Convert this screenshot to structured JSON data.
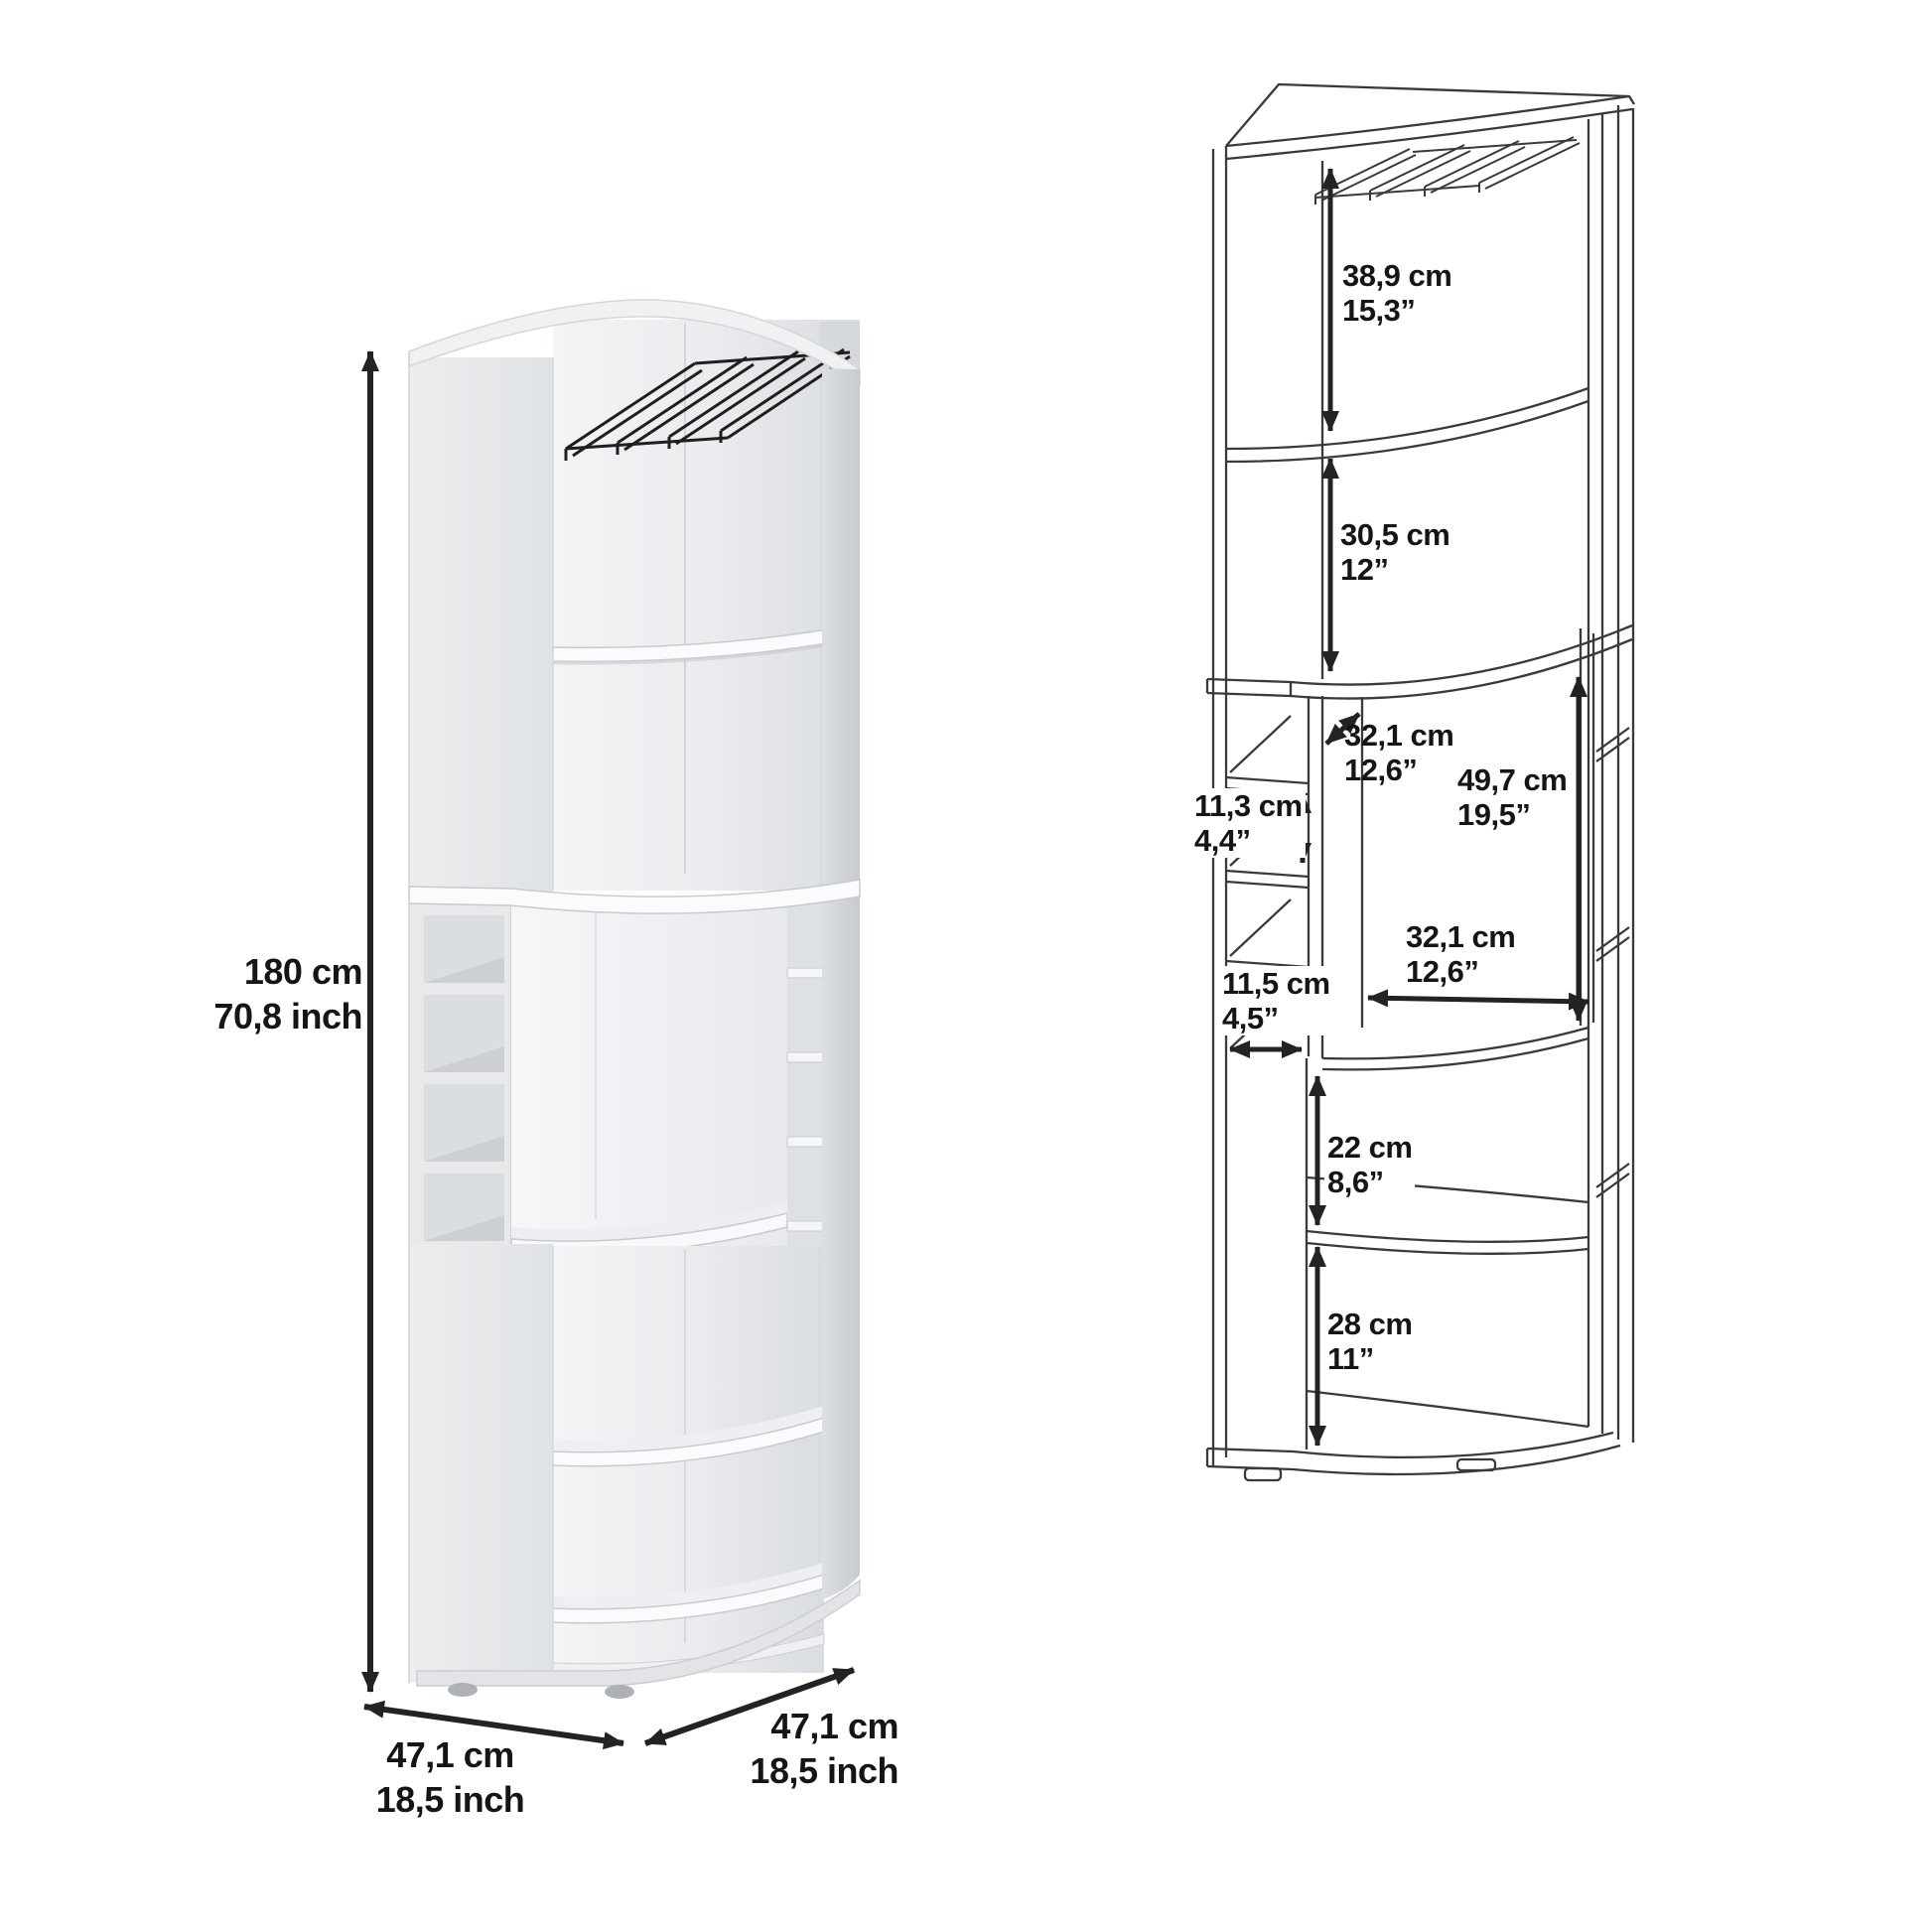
{
  "page": {
    "background": "#ffffff",
    "text_color": "#151515",
    "line_color": "#3a3a3a",
    "arrow_color": "#232323"
  },
  "product": {
    "type": "corner bar cabinet with stemware rack, bottle cubbies and curved shelves",
    "views": [
      "rendered-view",
      "dimension-line-diagram"
    ]
  },
  "left_view": {
    "name": "rendered-view",
    "overall": {
      "height": {
        "cm": "180 cm",
        "inch": "70,8 inch"
      },
      "depth_front_left": {
        "cm": "47,1 cm",
        "inch": "18,5 inch"
      },
      "depth_front_right": {
        "cm": "47,1 cm",
        "inch": "18,5 inch"
      }
    }
  },
  "right_view": {
    "name": "dimension-line-diagram",
    "dims": {
      "rack_section_height": {
        "cm": "38,9 cm",
        "inch": "15,3”"
      },
      "upper_section_height": {
        "cm": "30,5 cm",
        "inch": "12”"
      },
      "middle_depth": {
        "cm": "32,1 cm",
        "inch": "12,6”"
      },
      "middle_opening_height": {
        "cm": "49,7 cm",
        "inch": "19,5”"
      },
      "bottle_cubby_height": {
        "cm": "11,3 cm",
        "inch": "4,4”"
      },
      "middle_opening_width": {
        "cm": "32,1 cm",
        "inch": "12,6”"
      },
      "bottle_cubby_width": {
        "cm": "11,5 cm",
        "inch": "4,5”"
      },
      "lower_shelf_spacing": {
        "cm": "22 cm",
        "inch": "8,6”"
      },
      "bottom_shelf_spacing": {
        "cm": "28 cm",
        "inch": "11”"
      }
    }
  }
}
